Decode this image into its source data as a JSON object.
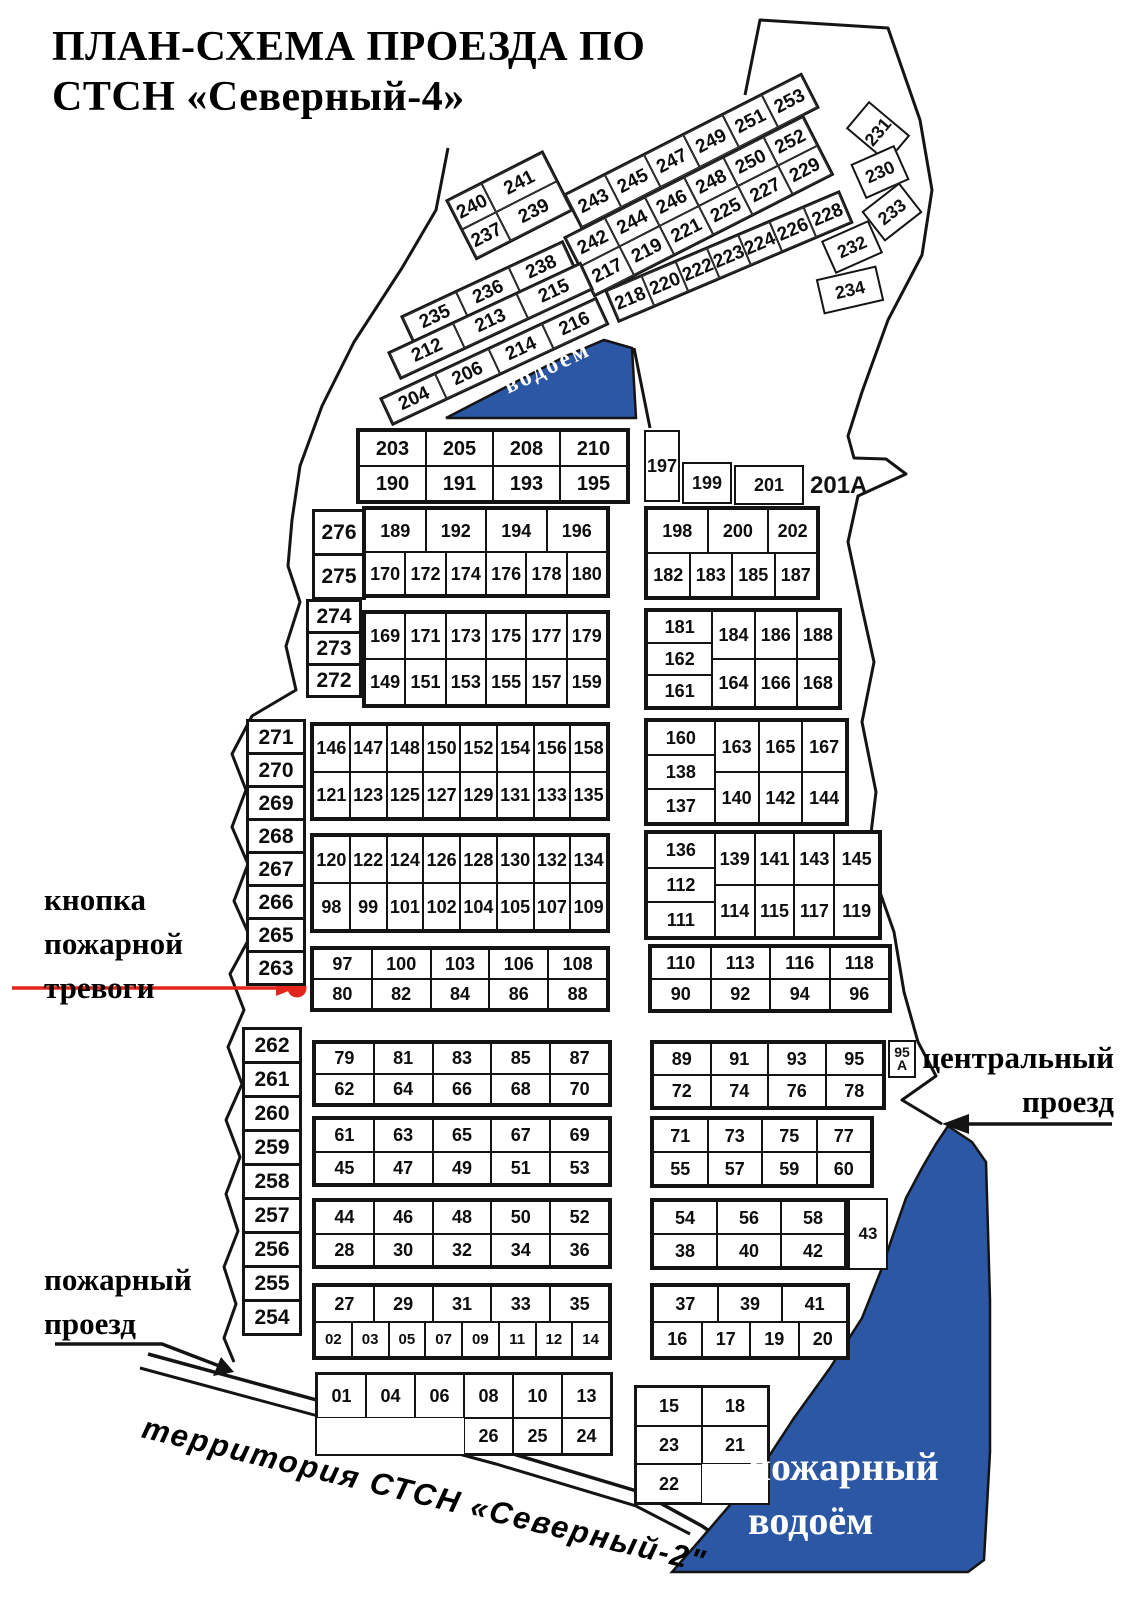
{
  "title": {
    "line1": "ПЛАН-СХЕМА ПРОЕЗДА ПО",
    "line2": "СТСН «Северный-4»"
  },
  "labels": {
    "fire_alarm": [
      "кнопка",
      "пожарной",
      "тревоги"
    ],
    "fire_passage": [
      "пожарный",
      "проезд"
    ],
    "central_passage": [
      "центральный",
      "проезд"
    ],
    "territory": "территория  СТСН «Северный-2\"",
    "pond": "водоём",
    "fire_pond": [
      "пожарный",
      "водоём"
    ],
    "plot_201a": "201A"
  },
  "colors": {
    "water": "#2b57a5",
    "red": "#e4251b",
    "line": "#141414"
  },
  "top_cluster": {
    "b241": [
      [
        "240",
        "241"
      ],
      [
        "237",
        "239"
      ]
    ],
    "strip_a": [
      [
        "243",
        "245",
        "247",
        "249",
        "251",
        "253"
      ]
    ],
    "strip_b": [
      [
        "242",
        "244",
        "246",
        "248",
        "250",
        "252"
      ],
      [
        "217",
        "219",
        "221",
        "225",
        "227",
        "229"
      ]
    ],
    "strip_c1": [
      [
        "235",
        "236",
        "238"
      ]
    ],
    "strip_c2": [
      [
        "212",
        "213",
        "215"
      ]
    ],
    "strip_c3": [
      [
        "204",
        "206",
        "214",
        "216"
      ]
    ],
    "strip_d": [
      [
        "218",
        "220",
        "222",
        "223",
        "224",
        "226",
        "228"
      ]
    ],
    "loose": {
      "p230": "230",
      "p231": "231",
      "p232": "232",
      "p233": "233",
      "p234": "234"
    }
  },
  "blocks": {
    "b1l": [
      [
        "203",
        "205",
        "208",
        "210"
      ],
      [
        "190",
        "191",
        "193",
        "195"
      ]
    ],
    "loose": {
      "p197": "197",
      "p199": "199",
      "p201": "201",
      "p43": "43"
    },
    "p95a": [
      "95",
      "A"
    ],
    "col276": [
      "276",
      "275"
    ],
    "col274": [
      "274",
      "273",
      "272"
    ],
    "leftcol_upper": [
      "271",
      "270",
      "269",
      "268",
      "267",
      "266",
      "265",
      "263"
    ],
    "leftcol_lower": [
      "262",
      "261",
      "260",
      "259",
      "258",
      "257",
      "256",
      "255",
      "254"
    ],
    "b2l": [
      [
        "189",
        "192",
        "194",
        "196"
      ],
      [
        "170",
        "172",
        "174",
        "176",
        "178",
        "180"
      ]
    ],
    "b2r": [
      [
        "198",
        "200",
        "202"
      ],
      [
        "182",
        "183",
        "185",
        "187"
      ]
    ],
    "b3l": [
      [
        "169",
        "171",
        "173",
        "175",
        "177",
        "179"
      ],
      [
        "149",
        "151",
        "153",
        "155",
        "157",
        "159"
      ]
    ],
    "b3r": [
      [
        "181",
        "162",
        "161"
      ],
      [
        "184",
        "164"
      ],
      [
        "186",
        "166"
      ],
      [
        "188",
        "168"
      ]
    ],
    "b4l": [
      [
        "146",
        "147",
        "148",
        "150",
        "152",
        "154",
        "156",
        "158"
      ],
      [
        "121",
        "123",
        "125",
        "127",
        "129",
        "131",
        "133",
        "135"
      ]
    ],
    "b4r": [
      [
        "160",
        "138",
        "137"
      ],
      [
        "163",
        "140"
      ],
      [
        "165",
        "142"
      ],
      [
        "167",
        "144"
      ]
    ],
    "b5l": [
      [
        "120",
        "122",
        "124",
        "126",
        "128",
        "130",
        "132",
        "134"
      ],
      [
        "98",
        "99",
        "101",
        "102",
        "104",
        "105",
        "107",
        "109"
      ]
    ],
    "b5r": [
      [
        "136",
        "112",
        "111"
      ],
      [
        "139",
        "114"
      ],
      [
        "141",
        "115"
      ],
      [
        "143",
        "117"
      ],
      [
        "145",
        "119"
      ]
    ],
    "b6l": [
      [
        "97",
        "100",
        "103",
        "106",
        "108"
      ],
      [
        "80",
        "82",
        "84",
        "86",
        "88"
      ]
    ],
    "b6r": [
      [
        "110",
        "113",
        "116",
        "118"
      ],
      [
        "90",
        "92",
        "94",
        "96"
      ]
    ],
    "b7l": [
      [
        "79",
        "81",
        "83",
        "85",
        "87"
      ],
      [
        "62",
        "64",
        "66",
        "68",
        "70"
      ]
    ],
    "b7r": [
      [
        "89",
        "91",
        "93",
        "95"
      ],
      [
        "72",
        "74",
        "76",
        "78"
      ]
    ],
    "b8l": [
      [
        "61",
        "63",
        "65",
        "67",
        "69"
      ],
      [
        "45",
        "47",
        "49",
        "51",
        "53"
      ]
    ],
    "b8r": [
      [
        "71",
        "73",
        "75",
        "77"
      ],
      [
        "55",
        "57",
        "59",
        "60"
      ]
    ],
    "b9l": [
      [
        "44",
        "46",
        "48",
        "50",
        "52"
      ],
      [
        "28",
        "30",
        "32",
        "34",
        "36"
      ]
    ],
    "b9r": [
      [
        "54",
        "56",
        "58"
      ],
      [
        "38",
        "40",
        "42"
      ]
    ],
    "b10l": [
      [
        "27",
        "29",
        "31",
        "33",
        "35"
      ],
      [
        "02",
        "03",
        "05",
        "07",
        "09",
        "11",
        "12",
        "14"
      ]
    ],
    "b10r": [
      [
        "37",
        "39",
        "41"
      ],
      [
        "16",
        "17",
        "19",
        "20"
      ]
    ],
    "b11l": [
      [
        "01",
        "04",
        "06",
        "08",
        "10",
        "13"
      ],
      [
        "",
        "",
        "",
        "26",
        "25",
        "24"
      ]
    ],
    "b11r": [
      [
        "15",
        "18"
      ],
      [
        "23",
        "21"
      ],
      [
        "22",
        ""
      ]
    ]
  }
}
